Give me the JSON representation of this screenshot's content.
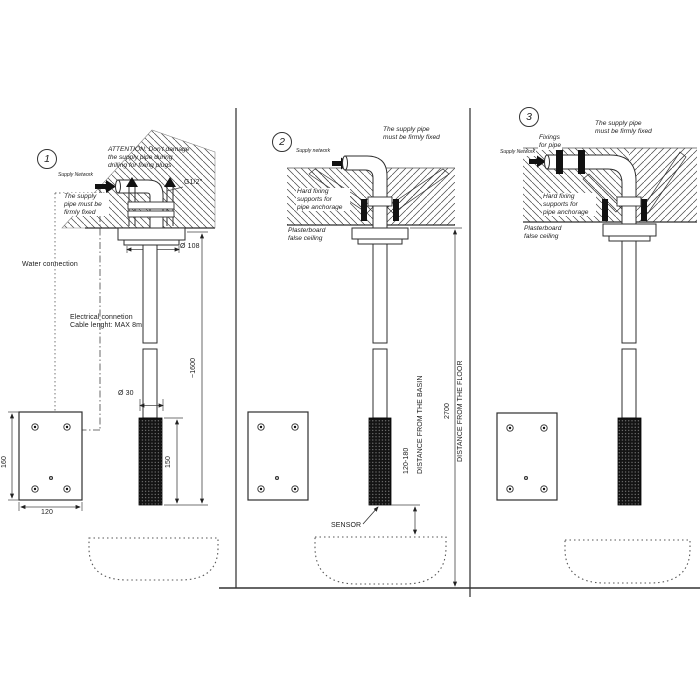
{
  "meta": {
    "type": "ceiling-mounted sensor tap installation diagram",
    "background_color": "#ffffff",
    "line_color": "#333333",
    "hatch_color": "#4a4a4a",
    "sensor_fill_color": "#141414"
  },
  "panels": [
    {
      "number": "1",
      "attention": "ATTENTION: Don't damage\nthe supply pipe during\ndrilling for fixing plugs",
      "supply_network": "Supply Network",
      "pipe_note": "The supply\npipe must be\nfirmly fixed",
      "thread": "G1/2\"",
      "water_connection": "Water connection",
      "electrical": "Electrical connetion\nCable lenght: MAX 8m",
      "flange_diameter": "Ø 108",
      "height_dim": "~1600",
      "spout_diameter": "Ø 30",
      "sensor_length": "150",
      "plate_height": "160",
      "plate_width": "120"
    },
    {
      "number": "2",
      "pipe_note": "The supply pipe\nmust be firmly fixed",
      "supply_network": "Supply network",
      "hard_fixing": "Hard fixing\nsupports for\npipe anchorage",
      "ceiling": "Plasterboard\nfalse ceiling",
      "sensor": "SENSOR",
      "basin_distance_value": "120-180",
      "basin_distance_label": "DISTANCE FROM THE BASIN",
      "floor_distance_value": "2700",
      "floor_distance_label": "DISTANCE FROM THE FLOOR"
    },
    {
      "number": "3",
      "fixings": "Fixings\nfor pipe",
      "pipe_note": "The supply pipe\nmust be firmly fixed",
      "supply_network": "Supply Network",
      "hard_fixing": "Hard fixing\nsupports for\npipe anchorage",
      "ceiling": "Plasterboard\nfalse ceiling"
    }
  ]
}
